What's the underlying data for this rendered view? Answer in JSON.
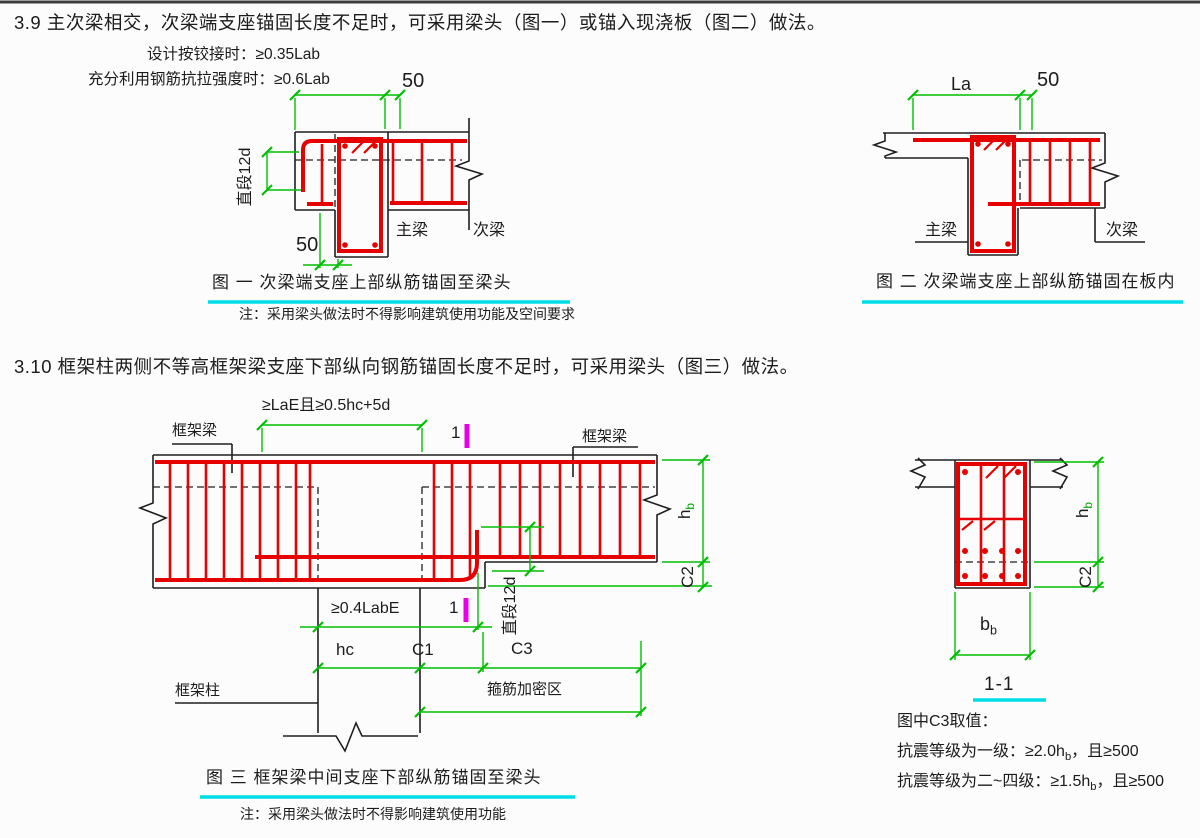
{
  "page": {
    "heading_39": "3.9  主次梁相交，次梁端支座锚固长度不足时，可采用梁头（图一）或锚入现浇板（图二）做法。",
    "heading_310": "3.10  框架柱两侧不等高框架梁支座下部纵向钢筋锚固长度不足时，可采用梁头（图三）做法。"
  },
  "colors": {
    "rebar_red": "#e60000",
    "dimension_green": "#00bf00",
    "underline_cyan": "#00dde8",
    "section_magenta": "#e800e8"
  },
  "fig1": {
    "ann_hinged": "设计按铰接时：≥0.35Lab",
    "ann_full_strength": "充分利用钢筋抗拉强度时：≥0.6Lab",
    "dim_50_top": "50",
    "dim_straight_12d": "直段12d",
    "dim_50_head": "50",
    "label_main_beam": "主梁",
    "label_secondary_beam": "次梁",
    "caption": "图 一  次梁端支座上部纵筋锚固至梁头",
    "note": "注：采用梁头做法时不得影响建筑使用功能及空间要求"
  },
  "fig2": {
    "dim_la": "La",
    "dim_50": "50",
    "label_main_beam": "主梁",
    "label_secondary_beam": "次梁",
    "caption": "图 二  次梁端支座上部纵筋锚固在板内"
  },
  "fig3": {
    "dim_top": "≥LaE且≥0.5hc+5d",
    "label_frame_beam": "框架梁",
    "section_mark": "1",
    "dim_anchor": "≥0.4LabE",
    "dim_straight_12d": "直段12d",
    "dim_hc": "hc",
    "dim_c1": "C1",
    "dim_c3": "C3",
    "dim_c2": "C2",
    "dim_hb": {
      "main": "h",
      "sub": "b"
    },
    "label_frame_column": "框架柱",
    "label_stirrup_zone": "箍筋加密区",
    "caption": "图 三  框架梁中间支座下部纵筋锚固至梁头",
    "note": "注：采用梁头做法时不得影响建筑使用功能"
  },
  "section11": {
    "title": "1-1",
    "dim_hb": {
      "main": "h",
      "sub": "b"
    },
    "dim_c2": "C2",
    "dim_bb": {
      "main": "b",
      "sub": "b"
    },
    "c3_note": {
      "title": "图中C3取值：",
      "line1": {
        "pre": "抗震等级为一级：≥2.0h",
        "sub": "b",
        "post": "，且≥500"
      },
      "line2": {
        "pre": "抗震等级为二~四级：≥1.5h",
        "sub": "b",
        "post": "，且≥500"
      }
    }
  }
}
